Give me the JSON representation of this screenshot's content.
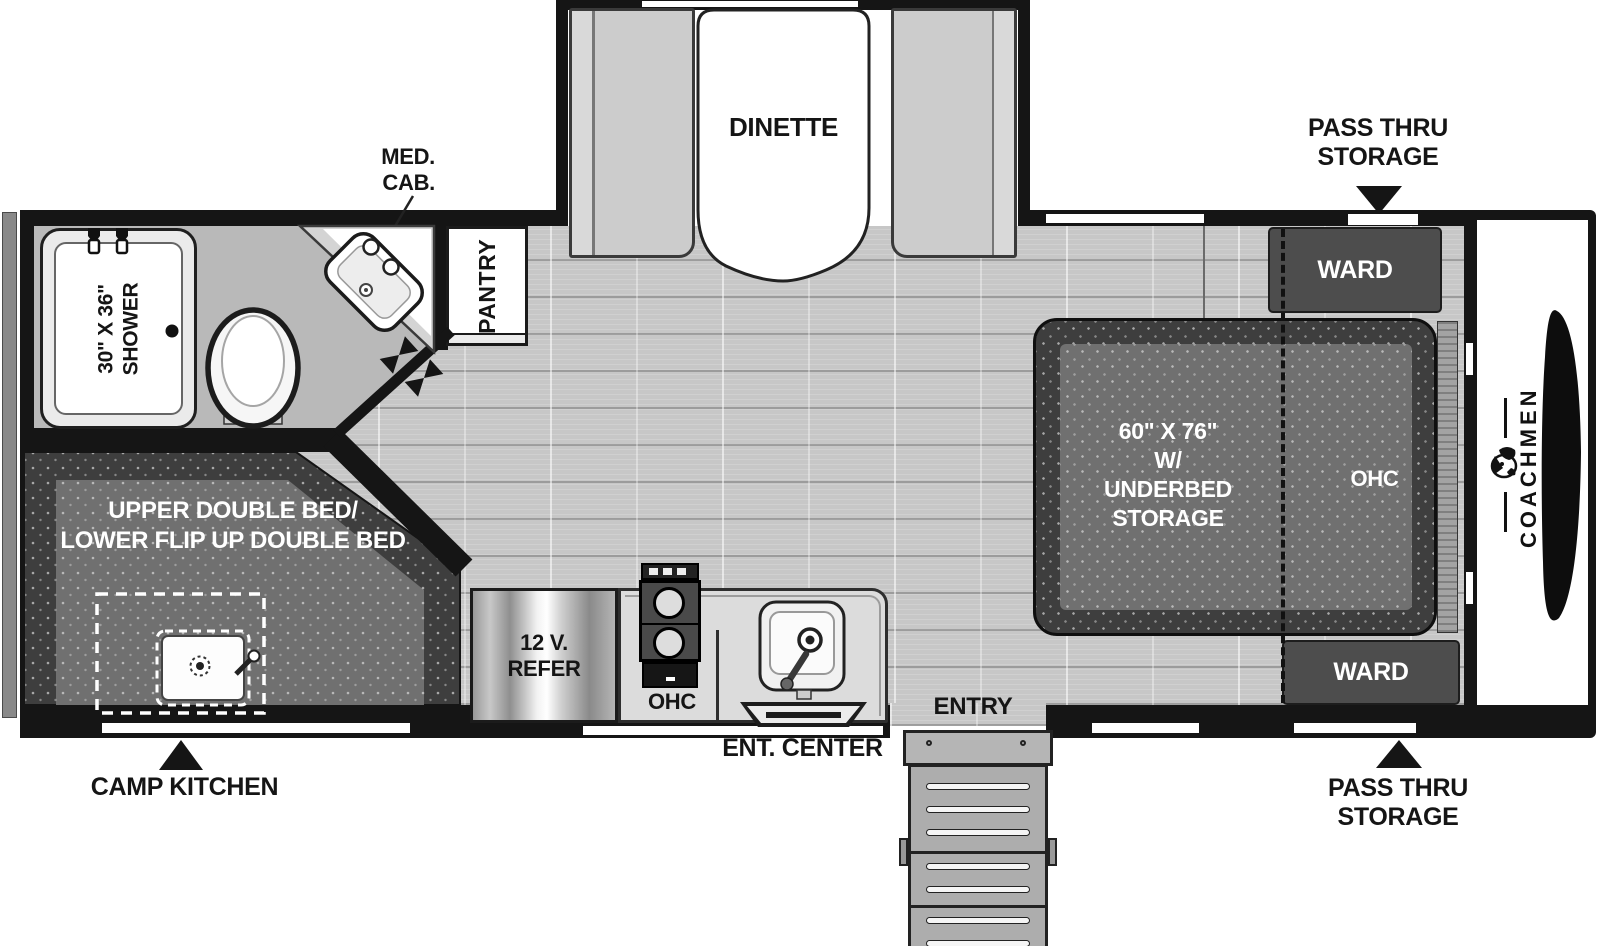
{
  "brand": {
    "name": "COACHMEN",
    "logo_icon": "dog-mascot"
  },
  "colors": {
    "wall": "#151515",
    "floor": "#c7c7c7",
    "bath_floor": "#b9b9b9",
    "bed_dark": "#3e3e3e",
    "bed_inner": "#707070",
    "cabinet": "#4d4d4d",
    "bench": "#cccccc",
    "counter": "#dcdcdc",
    "label_text": "#151515",
    "label_text_on_dark": "#ffffff"
  },
  "callouts": {
    "pass_thru_top": {
      "l1": "PASS THRU",
      "l2": "STORAGE"
    },
    "pass_thru_bottom": {
      "l1": "PASS THRU",
      "l2": "STORAGE"
    },
    "camp_kitchen": "CAMP KITCHEN",
    "ent_center": "ENT. CENTER",
    "med_cab": {
      "l1": "MED.",
      "l2": "CAB."
    }
  },
  "rooms": {
    "dinette": "DINETTE",
    "pantry": "PANTRY",
    "shower": {
      "l1": "30\" X 36\"",
      "l2": "SHOWER"
    },
    "bunk": {
      "l1": "UPPER DOUBLE BED/",
      "l2": "LOWER FLIP UP DOUBLE BED"
    },
    "refer": {
      "l1": "12 V.",
      "l2": "REFER"
    },
    "kitchen_ohc": "OHC",
    "entry": "ENTRY",
    "bed": {
      "l1": "60\" X 76\"",
      "l2": "W/",
      "l3": "UNDERBED",
      "l4": "STORAGE"
    },
    "bed_ohc": "OHC",
    "ward_top": "WARD",
    "ward_bottom": "WARD"
  },
  "icons": {
    "arrow_down": "triangle-down",
    "arrow_up": "triangle-up",
    "door_hinge": "bowtie",
    "toilet": "oval-toilet-top-view",
    "corner_sink": "angled-lav-sink",
    "kitchen_sink": "square-sink-with-faucet",
    "cooktop": "two-burner-range",
    "shower_heads": "dual-shower-valves",
    "tv": "flatscreen-top-view",
    "front_cap": "trailer-nose-shape"
  }
}
